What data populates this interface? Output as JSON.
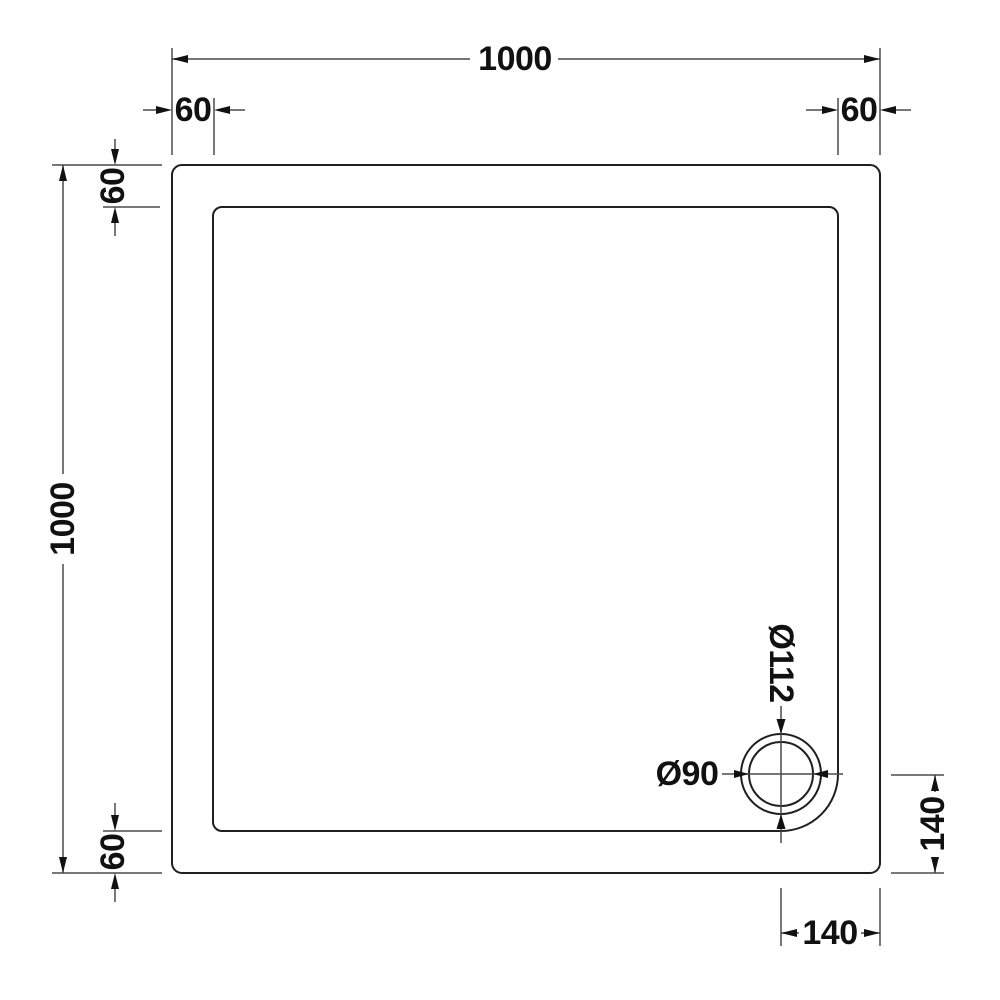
{
  "drawing": {
    "type": "technical-dimension-drawing",
    "subject": "square shower tray plan view with waste drain",
    "background": "#ffffff",
    "line_color": "#1f1f1f",
    "dimension_line_color": "#4a4a4a",
    "labels": {
      "overall_width": "1000",
      "overall_depth": "1000",
      "flange_top_left": "60",
      "flange_top_right": "60",
      "flange_left_top": "60",
      "flange_left_bottom": "60",
      "waste_outer_diameter": "Ø112",
      "waste_inner_diameter": "Ø90",
      "waste_offset_right": "140",
      "waste_offset_bottom": "140"
    }
  }
}
